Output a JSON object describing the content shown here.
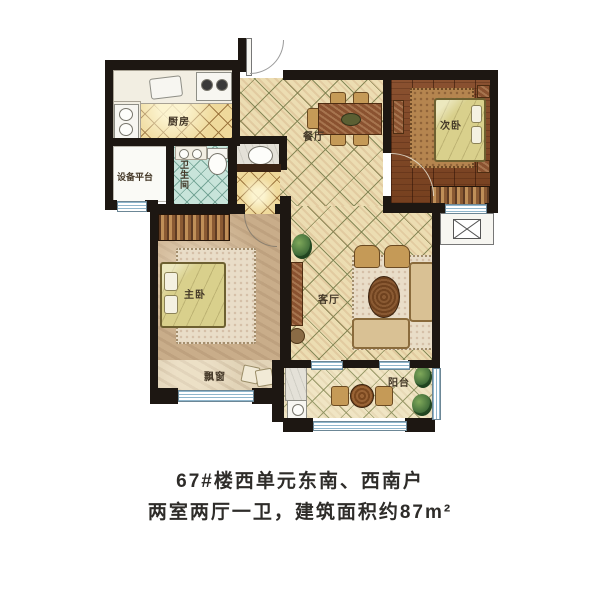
{
  "plan": {
    "rooms": {
      "kitchen": {
        "label": "厨房"
      },
      "equipment_platform": {
        "label": "设备平台"
      },
      "bathroom": {
        "label": "卫生间"
      },
      "dining": {
        "label": "餐厅"
      },
      "second_bedroom": {
        "label": "次卧"
      },
      "master_bedroom": {
        "label": "主卧"
      },
      "living": {
        "label": "客厅"
      },
      "bay_window": {
        "label": "飘窗"
      },
      "balcony": {
        "label": "阳台"
      }
    },
    "colors": {
      "wall": "#1d1712",
      "warm_tile": "#ecddb2",
      "kitchen_tile": "#efd99b",
      "bath_tile": "#c8e4da",
      "bedroom_wood": "#82492a",
      "window_blue": "#8fb6cc",
      "caption_text": "#2e2c29"
    }
  },
  "caption": {
    "line1": "67#楼西单元东南、西南户",
    "line2": "两室两厅一卫，建筑面积约87m²"
  }
}
